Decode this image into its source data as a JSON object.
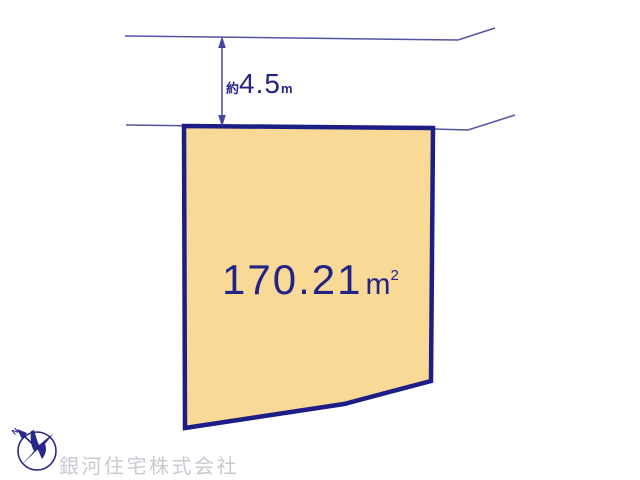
{
  "site_plan": {
    "parcel": {
      "area_value": "170.21",
      "area_unit_base": "m",
      "area_unit_exponent": "2",
      "fill_color": "#f8d996",
      "border_color": "#1d1d87"
    },
    "frontage_dimension": {
      "approx_prefix": "約",
      "value": "4.5",
      "unit": "m"
    },
    "compass": {
      "north_label": "N",
      "color": "#28288c"
    },
    "road_line_color": "#5353a3",
    "dimension_color": "#4646a0",
    "text_color": "#232387"
  },
  "footer": {
    "company_name": "銀河住宅株式会社"
  }
}
